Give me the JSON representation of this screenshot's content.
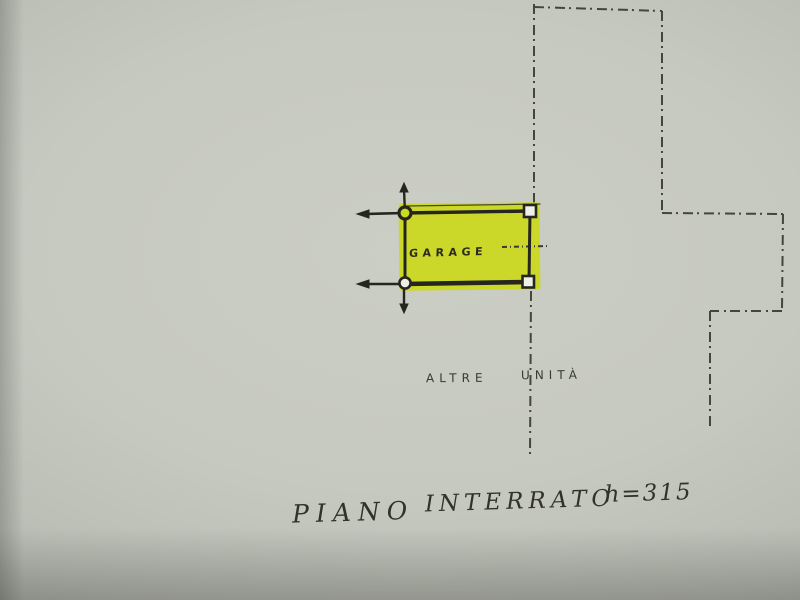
{
  "plan": {
    "room_label": "GARAGE",
    "adjacent_units": {
      "word_left": "ALTRE",
      "word_right": "UNITÀ"
    },
    "caption": {
      "floor_word": "PIANO",
      "level_word": "INTERRATO",
      "height_note": "h=315"
    },
    "colors": {
      "highlight_yellow": "#cbd922",
      "ink": "#26261f",
      "dashed_boundary": "#45453e",
      "paper": "#c6c9c0"
    }
  }
}
